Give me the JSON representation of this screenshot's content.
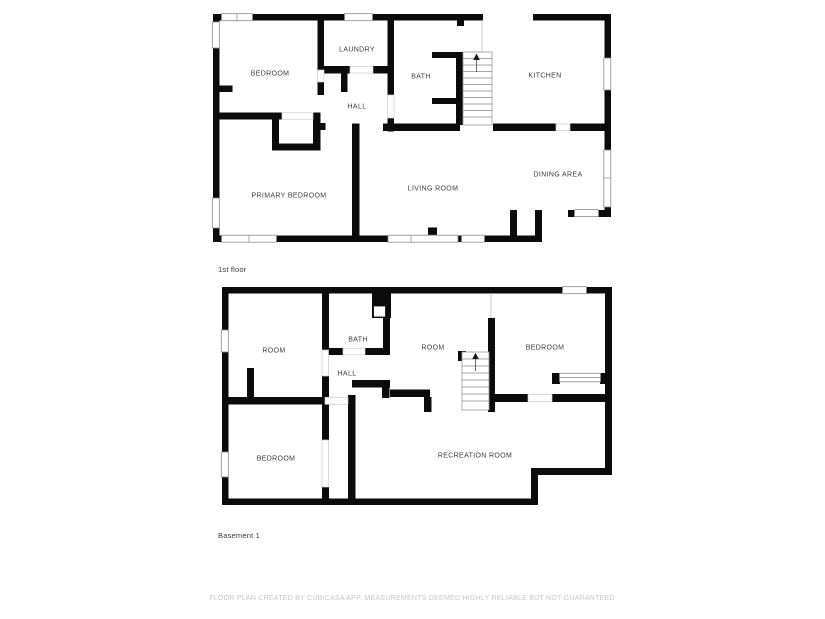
{
  "floors": [
    {
      "title": "1st floor",
      "rooms": [
        {
          "label": "BEDROOM"
        },
        {
          "label": "LAUNDRY"
        },
        {
          "label": "HALL"
        },
        {
          "label": "BATH"
        },
        {
          "label": "KITCHEN"
        },
        {
          "label": "PRIMARY BEDROOM"
        },
        {
          "label": "LIVING ROOM"
        },
        {
          "label": "DINING AREA"
        }
      ]
    },
    {
      "title": "Basement 1",
      "rooms": [
        {
          "label": "ROOM"
        },
        {
          "label": "BATH"
        },
        {
          "label": "HALL"
        },
        {
          "label": "ROOM"
        },
        {
          "label": "BEDROOM"
        },
        {
          "label": "BEDROOM"
        },
        {
          "label": "RECREATION ROOM"
        }
      ]
    }
  ],
  "footer": {
    "disclaimer": "FLOOR PLAN CREATED BY CUBICASA APP. MEASUREMENTS DEEMED HIGHLY RELIABLE BUT NOT GUARANTEED"
  },
  "colors": {
    "wall": "#0b0b0b",
    "room_label": "#3c3c3c",
    "window_line": "#8a8a8a",
    "door_line": "#cccccc",
    "stair_line": "#9a9a9a",
    "footer_text": "#c7c7c7",
    "background": "#ffffff"
  }
}
